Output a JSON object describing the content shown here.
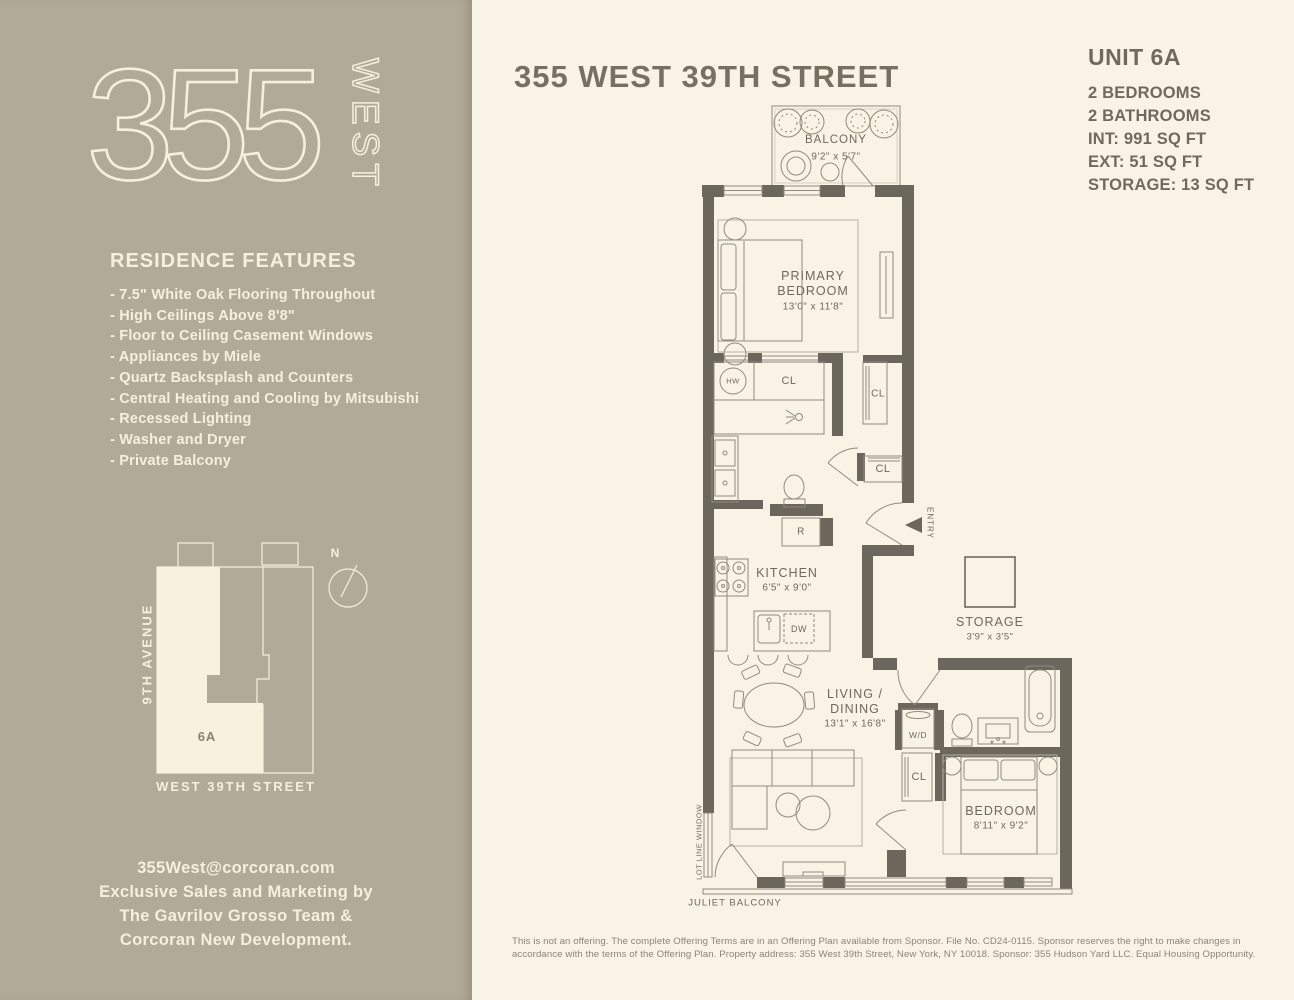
{
  "sidebar": {
    "logo": {
      "number": "355",
      "word": "WEST"
    },
    "features": {
      "heading": "RESIDENCE FEATURES",
      "items": [
        "7.5\" White Oak Flooring Throughout",
        "High Ceilings Above 8'8\"",
        "Floor to Ceiling Casement Windows",
        "Appliances by Miele",
        "Quartz Backsplash and Counters",
        "Central Heating and Cooling by Mitsubishi",
        "Recessed Lighting",
        "Washer and Dryer",
        "Private Balcony"
      ]
    },
    "keyplan": {
      "avenue_label": "9TH AVENUE",
      "street_label": "WEST 39TH STREET",
      "unit_label": "6A",
      "north_label": "N"
    },
    "contact": {
      "email": "355West@corcoran.com",
      "line2": "Exclusive Sales and Marketing by",
      "line3": "The Gavrilov Grosso Team &",
      "line4": "Corcoran New Development."
    }
  },
  "header": {
    "title": "355 WEST 39TH STREET"
  },
  "unit_info": {
    "unit": "UNIT 6A",
    "specs": [
      "2 BEDROOMS",
      "2 BATHROOMS",
      "INT: 991 SQ FT",
      "EXT: 51 SQ FT",
      "STORAGE: 13 SQ FT"
    ]
  },
  "floorplan": {
    "balcony": {
      "name": "BALCONY",
      "dims": "9'2\" x 5'7\""
    },
    "primary_bedroom": {
      "name_line1": "PRIMARY",
      "name_line2": "BEDROOM",
      "dims": "13'0\" x 11'8\""
    },
    "kitchen": {
      "name": "KITCHEN",
      "dims": "6'5\" x 9'0\""
    },
    "living_dining": {
      "name_line1": "LIVING /",
      "name_line2": "DINING",
      "dims": "13'1\" x 16'8\""
    },
    "bedroom2": {
      "name": "BEDROOM",
      "dims": "8'11\" x 9'2\""
    },
    "storage": {
      "name": "STORAGE",
      "dims": "3'9\" x 3'5\""
    },
    "labels": {
      "hw": "HW",
      "cl": "CL",
      "r": "R",
      "dw": "DW",
      "wd": "W/D",
      "entry": "ENTRY",
      "lot_line_window": "LOT LINE WINDOW",
      "juliet_balcony": "JULIET BALCONY"
    }
  },
  "disclaimer": {
    "line1": "This is not an offering. The complete Offering Terms are in an Offering Plan available from Sponsor. File No. CD24-0115. Sponsor reserves the right to make changes in",
    "line2": "accordance with the terms of the Offering Plan. Property address: 355 West 39th Street, New York, NY 10018. Sponsor: 355 Hudson Yard LLC. Equal Housing Opportunity."
  },
  "colors": {
    "sidebar_bg": "#b1aa98",
    "main_bg": "#f9f3e6",
    "cream": "#f6efdc",
    "wall": "#6b675c",
    "line": "#908b7d",
    "text": "#6e695c"
  }
}
